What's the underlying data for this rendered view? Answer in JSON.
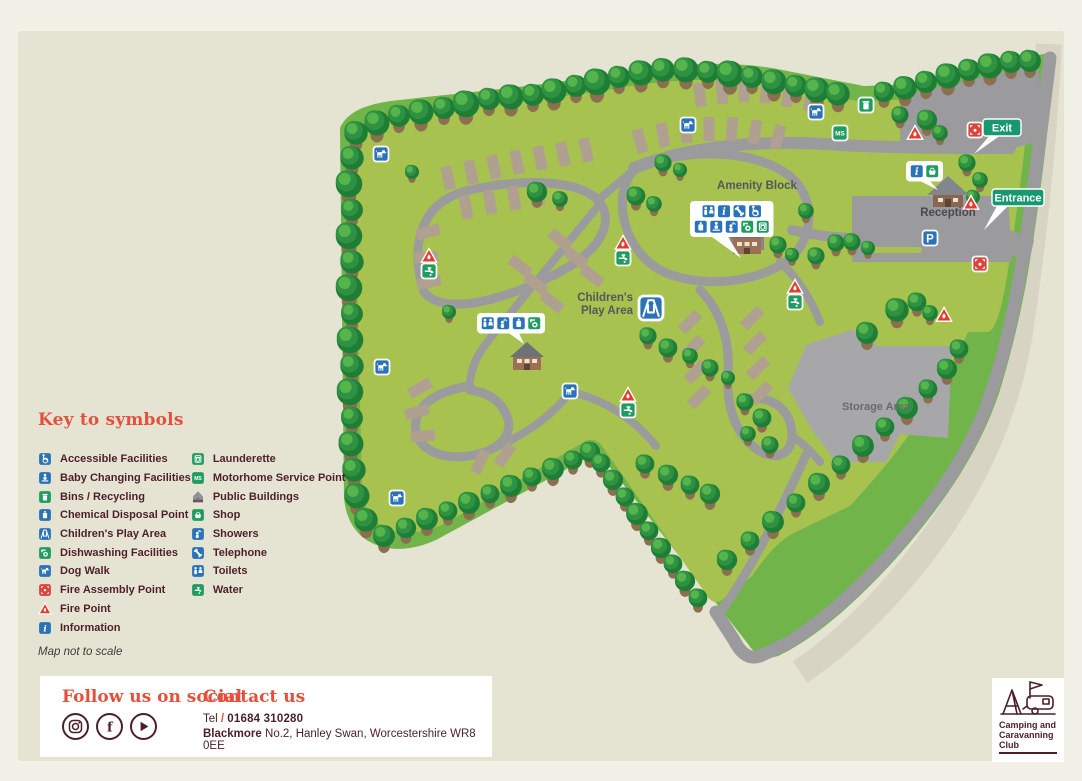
{
  "palette": {
    "card": "#e5e4d3",
    "band": "#70b44a",
    "field": "#a7c24f",
    "road": "#9b9b9e",
    "public_road": "#d7d4c3",
    "pitch": "#b0a08f",
    "storage": "#a7a7a9",
    "blue": "#2a73b8",
    "green": "#1f9d60",
    "teal": "#17986f",
    "fire": "#e23d2e",
    "assembly": "#d9453f",
    "maroon": "#4a1f27",
    "heading": "#e5503c",
    "label": "#56575a"
  },
  "legend": {
    "title": "Key to symbols",
    "note": "Map not to scale",
    "columns": [
      [
        {
          "icon": "accessible",
          "label": "Accessible Facilities"
        },
        {
          "icon": "baby-changing",
          "label": "Baby Changing Facilities"
        },
        {
          "icon": "bins",
          "label": "Bins / Recycling"
        },
        {
          "icon": "chemical",
          "label": "Chemical Disposal Point"
        },
        {
          "icon": "play-area",
          "label": "Children's Play Area"
        },
        {
          "icon": "dishwashing",
          "label": "Dishwashing Facilities"
        },
        {
          "icon": "dog-walk",
          "label": "Dog Walk"
        },
        {
          "icon": "fire-assembly",
          "label": "Fire Assembly Point"
        },
        {
          "icon": "fire-point",
          "label": "Fire Point"
        },
        {
          "icon": "information",
          "label": "Information"
        }
      ],
      [
        {
          "icon": "launderette",
          "label": "Launderette"
        },
        {
          "icon": "mhs",
          "label": "Motorhome Service Point"
        },
        {
          "icon": "public-buildings",
          "label": "Public Buildings"
        },
        {
          "icon": "shop",
          "label": "Shop"
        },
        {
          "icon": "showers",
          "label": "Showers"
        },
        {
          "icon": "telephone",
          "label": "Telephone"
        },
        {
          "icon": "toilets",
          "label": "Toilets"
        },
        {
          "icon": "water",
          "label": "Water"
        }
      ]
    ]
  },
  "map": {
    "labels": [
      {
        "text": "Amenity Block",
        "x": 757,
        "y": 189,
        "anchor": "middle",
        "size": 11.5,
        "color": "#56575a"
      },
      {
        "text": "Children's",
        "x": 633,
        "y": 301,
        "anchor": "end",
        "size": 11.5,
        "color": "#56575a"
      },
      {
        "text": "Play Area",
        "x": 633,
        "y": 314,
        "anchor": "end",
        "size": 11.5,
        "color": "#56575a"
      },
      {
        "text": "Reception",
        "x": 948,
        "y": 216,
        "anchor": "middle",
        "size": 11.5,
        "color": "#4a4a4c"
      },
      {
        "text": "Storage Area",
        "x": 876,
        "y": 410,
        "anchor": "middle",
        "size": 11,
        "color": "#6a6a6c"
      }
    ],
    "badges": [
      {
        "text": "Exit",
        "x": 983,
        "y": 119,
        "w": 38,
        "pointer": [
          990,
          135,
          1001,
          135,
          974,
          154
        ]
      },
      {
        "text": "Entrance",
        "x": 992,
        "y": 189,
        "w": 52,
        "pointer": [
          998,
          204,
          1010,
          204,
          984,
          230
        ]
      }
    ],
    "buildings": [
      {
        "type": "amenity",
        "x": 747,
        "y": 240
      },
      {
        "type": "house",
        "x": 527,
        "y": 356
      },
      {
        "type": "reception",
        "x": 948,
        "y": 192
      }
    ],
    "callouts": [
      {
        "x": 690,
        "y": 201,
        "rows": [
          [
            "toilets",
            "information",
            "telephone",
            "accessible"
          ],
          [
            "chemical",
            "baby-changing",
            "showers",
            "dishwashing",
            "launderette"
          ]
        ],
        "pointer": [
          712,
          237,
          728,
          237,
          741,
          258
        ]
      },
      {
        "x": 477,
        "y": 313,
        "rows": [
          [
            "toilets",
            "showers",
            "chemical",
            "dishwashing"
          ]
        ],
        "pointer": [
          506,
          331,
          518,
          331,
          524,
          344
        ]
      },
      {
        "x": 906,
        "y": 161,
        "rows": [
          [
            "information",
            "shop"
          ]
        ],
        "pointer": [
          916,
          179,
          928,
          179,
          938,
          190
        ]
      }
    ],
    "icons": [
      {
        "type": "dog-walk",
        "x": 381,
        "y": 154
      },
      {
        "type": "dog-walk",
        "x": 688,
        "y": 125
      },
      {
        "type": "dog-walk",
        "x": 816,
        "y": 112
      },
      {
        "type": "dog-walk",
        "x": 382,
        "y": 367
      },
      {
        "type": "dog-walk",
        "x": 570,
        "y": 391
      },
      {
        "type": "dog-walk",
        "x": 397,
        "y": 498
      },
      {
        "type": "bins",
        "x": 866,
        "y": 105
      },
      {
        "type": "mhs",
        "x": 840,
        "y": 133
      },
      {
        "type": "parking",
        "x": 930,
        "y": 238
      },
      {
        "type": "play-area",
        "x": 651,
        "y": 308,
        "size": 24
      },
      {
        "type": "fire-point",
        "x": 915,
        "y": 133
      },
      {
        "type": "fire-point",
        "x": 971,
        "y": 203
      },
      {
        "type": "fire-point",
        "x": 944,
        "y": 315
      },
      {
        "type": "fire-point",
        "x": 429,
        "y": 256
      },
      {
        "type": "water",
        "x": 429,
        "y": 271
      },
      {
        "type": "fire-point",
        "x": 623,
        "y": 243
      },
      {
        "type": "water",
        "x": 623,
        "y": 258
      },
      {
        "type": "fire-point",
        "x": 795,
        "y": 287
      },
      {
        "type": "water",
        "x": 795,
        "y": 302
      },
      {
        "type": "fire-point",
        "x": 628,
        "y": 395
      },
      {
        "type": "water",
        "x": 628,
        "y": 410
      },
      {
        "type": "fire-assembly",
        "x": 975,
        "y": 130
      },
      {
        "type": "fire-assembly",
        "x": 980,
        "y": 264
      }
    ],
    "trees": [
      [
        356,
        133,
        15
      ],
      [
        377,
        123,
        16
      ],
      [
        399,
        116,
        14
      ],
      [
        421,
        112,
        16
      ],
      [
        444,
        108,
        14
      ],
      [
        466,
        104,
        17
      ],
      [
        489,
        99,
        14
      ],
      [
        511,
        97,
        16
      ],
      [
        533,
        95,
        14
      ],
      [
        554,
        91,
        16
      ],
      [
        576,
        86,
        14
      ],
      [
        597,
        82,
        17
      ],
      [
        619,
        77,
        14
      ],
      [
        641,
        73,
        16
      ],
      [
        663,
        70,
        15
      ],
      [
        686,
        70,
        16
      ],
      [
        708,
        72,
        14
      ],
      [
        730,
        74,
        17
      ],
      [
        752,
        77,
        14
      ],
      [
        774,
        82,
        16
      ],
      [
        796,
        86,
        14
      ],
      [
        817,
        90,
        16
      ],
      [
        838,
        94,
        15
      ],
      [
        884,
        92,
        13
      ],
      [
        905,
        88,
        15
      ],
      [
        926,
        82,
        14
      ],
      [
        948,
        76,
        16
      ],
      [
        969,
        70,
        14
      ],
      [
        990,
        66,
        16
      ],
      [
        1011,
        62,
        14
      ],
      [
        1030,
        61,
        14
      ],
      [
        352,
        158,
        15
      ],
      [
        349,
        184,
        17
      ],
      [
        352,
        210,
        14
      ],
      [
        349,
        236,
        17
      ],
      [
        352,
        262,
        15
      ],
      [
        349,
        288,
        17
      ],
      [
        352,
        314,
        14
      ],
      [
        350,
        340,
        17
      ],
      [
        352,
        366,
        15
      ],
      [
        350,
        392,
        17
      ],
      [
        352,
        418,
        14
      ],
      [
        351,
        444,
        16
      ],
      [
        354,
        470,
        15
      ],
      [
        357,
        496,
        16
      ],
      [
        366,
        520,
        15
      ],
      [
        384,
        536,
        14
      ],
      [
        406,
        528,
        13
      ],
      [
        427,
        519,
        14
      ],
      [
        448,
        511,
        12
      ],
      [
        469,
        503,
        14
      ],
      [
        490,
        494,
        12
      ],
      [
        511,
        486,
        14
      ],
      [
        532,
        477,
        12
      ],
      [
        553,
        469,
        14
      ],
      [
        573,
        460,
        12
      ],
      [
        590,
        452,
        13
      ],
      [
        601,
        463,
        12
      ],
      [
        613,
        480,
        13
      ],
      [
        625,
        497,
        12
      ],
      [
        637,
        514,
        14
      ],
      [
        649,
        531,
        12
      ],
      [
        661,
        548,
        13
      ],
      [
        673,
        564,
        12
      ],
      [
        685,
        581,
        13
      ],
      [
        698,
        598,
        12
      ],
      [
        727,
        560,
        13
      ],
      [
        750,
        541,
        12
      ],
      [
        773,
        522,
        14
      ],
      [
        796,
        503,
        12
      ],
      [
        819,
        484,
        14
      ],
      [
        841,
        465,
        12
      ],
      [
        863,
        446,
        14
      ],
      [
        885,
        427,
        12
      ],
      [
        907,
        408,
        14
      ],
      [
        928,
        389,
        12
      ],
      [
        947,
        369,
        13
      ],
      [
        959,
        349,
        12
      ],
      [
        645,
        464,
        12
      ],
      [
        668,
        475,
        13
      ],
      [
        690,
        485,
        12
      ],
      [
        710,
        494,
        13
      ],
      [
        537,
        192,
        13
      ],
      [
        560,
        199,
        10
      ],
      [
        636,
        196,
        12
      ],
      [
        654,
        204,
        10
      ],
      [
        663,
        163,
        11
      ],
      [
        680,
        170,
        9
      ],
      [
        778,
        245,
        11
      ],
      [
        792,
        255,
        9
      ],
      [
        806,
        211,
        10
      ],
      [
        816,
        256,
        11
      ],
      [
        836,
        243,
        11
      ],
      [
        648,
        336,
        11
      ],
      [
        668,
        348,
        12
      ],
      [
        690,
        356,
        10
      ],
      [
        710,
        368,
        11
      ],
      [
        728,
        378,
        9
      ],
      [
        745,
        402,
        11
      ],
      [
        762,
        418,
        12
      ],
      [
        748,
        434,
        10
      ],
      [
        770,
        445,
        11
      ],
      [
        867,
        333,
        14
      ],
      [
        897,
        310,
        15
      ],
      [
        917,
        302,
        12
      ],
      [
        930,
        313,
        10
      ],
      [
        900,
        115,
        11
      ],
      [
        927,
        120,
        13
      ],
      [
        940,
        133,
        10
      ],
      [
        967,
        163,
        11
      ],
      [
        980,
        180,
        10
      ],
      [
        973,
        197,
        9
      ],
      [
        852,
        242,
        11
      ],
      [
        868,
        248,
        9
      ],
      [
        449,
        312,
        9
      ],
      [
        412,
        172,
        9
      ]
    ],
    "pitches": [
      [
        700,
        95,
        -8
      ],
      [
        722,
        92,
        -5
      ],
      [
        744,
        90,
        0
      ],
      [
        766,
        91,
        5
      ],
      [
        788,
        95,
        8
      ],
      [
        810,
        99,
        10
      ],
      [
        640,
        141,
        -15
      ],
      [
        663,
        135,
        -10
      ],
      [
        686,
        131,
        -5
      ],
      [
        709,
        129,
        0
      ],
      [
        732,
        129,
        5
      ],
      [
        755,
        132,
        10
      ],
      [
        778,
        137,
        15
      ],
      [
        448,
        178,
        -12
      ],
      [
        471,
        172,
        -12
      ],
      [
        494,
        167,
        -12
      ],
      [
        517,
        162,
        -12
      ],
      [
        540,
        158,
        -12
      ],
      [
        563,
        154,
        -12
      ],
      [
        586,
        150,
        -12
      ],
      [
        466,
        207,
        -10
      ],
      [
        490,
        202,
        -10
      ],
      [
        514,
        198,
        -10
      ],
      [
        538,
        194,
        -10
      ],
      [
        428,
        232,
        75
      ],
      [
        426,
        257,
        85
      ],
      [
        429,
        282,
        80
      ],
      [
        560,
        240,
        -52
      ],
      [
        576,
        258,
        -52
      ],
      [
        592,
        276,
        -52
      ],
      [
        520,
        266,
        -52
      ],
      [
        536,
        284,
        -52
      ],
      [
        552,
        302,
        -52
      ],
      [
        690,
        322,
        45
      ],
      [
        693,
        347,
        45
      ],
      [
        696,
        372,
        45
      ],
      [
        699,
        397,
        45
      ],
      [
        752,
        318,
        45
      ],
      [
        755,
        343,
        45
      ],
      [
        758,
        368,
        45
      ],
      [
        761,
        393,
        45
      ],
      [
        420,
        388,
        60
      ],
      [
        417,
        412,
        75
      ],
      [
        423,
        436,
        85
      ],
      [
        480,
        462,
        25
      ],
      [
        505,
        455,
        35
      ]
    ]
  },
  "footer": {
    "social_heading": "Follow us on social",
    "social_icons": [
      "instagram",
      "facebook",
      "youtube"
    ],
    "contact_heading": "Contact us",
    "tel_label": "Tel",
    "tel_sep": " / ",
    "tel_number": "01684 310280",
    "address_bold": "Blackmore",
    "address_rest": " No.2, Hanley Swan, Worcestershire WR8 0EE"
  },
  "logo": {
    "lines": [
      "Camping and",
      "Caravanning",
      "Club"
    ]
  }
}
